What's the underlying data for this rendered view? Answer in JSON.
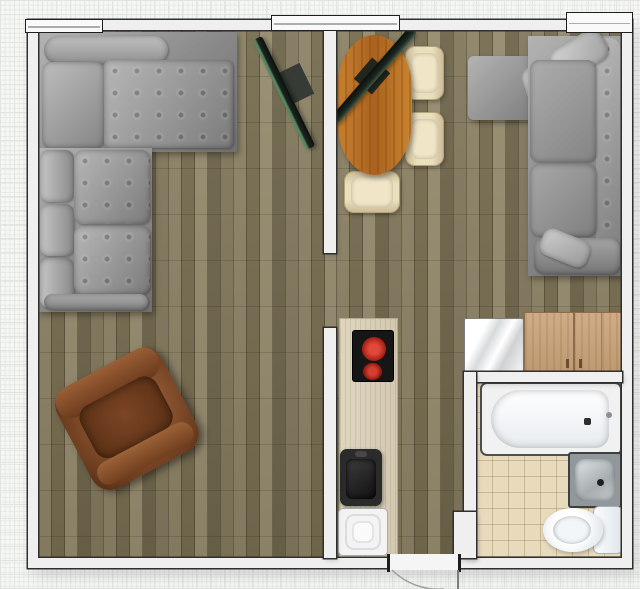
{
  "scene": {
    "kind": "floor-plan",
    "view": "top-down 2D",
    "background": "graph-paper grid",
    "text_visible": "none"
  },
  "palette": {
    "paper": "#f6f7f4",
    "grid_line": "#e0e5e0",
    "wall_fill": "#efefef",
    "wall_line": "#2f2f2f",
    "floor_wood": "#7f755a",
    "counter_wood": "#dbd1ba",
    "bath_tile": "#e8dabd",
    "sofa_gray": "#9a9a9a",
    "armchair_brown": "#7c4a28",
    "table_wood": "#c07a30",
    "chair_beige": "#e6d8b6",
    "tv_dark": "#15211b",
    "tv_green_edge": "#57865f",
    "burner_red": "#c43327",
    "steel": "#aab0b2",
    "fixture_white": "#f7f9fa",
    "wardrobe_tan": "#c8a47e"
  },
  "rooms": [
    {
      "id": "living-room",
      "position": "left",
      "floor": "wood planks"
    },
    {
      "id": "dining-living-area",
      "position": "top-right",
      "floor": "wood planks"
    },
    {
      "id": "kitchen-hall",
      "position": "bottom-center",
      "floor": "wood planks"
    },
    {
      "id": "bathroom",
      "position": "bottom-right",
      "floor": "beige tile"
    }
  ],
  "openings": {
    "windows": [
      "window-top-left",
      "window-top-center",
      "window-top-right-corner"
    ],
    "doors": [
      "entrance-door-bottom (swing arc outside)",
      "living-room-wall-opening"
    ]
  },
  "furniture": [
    {
      "id": "sectional-sofa-left",
      "desc": "gray L-shaped corner sofa",
      "room": "living-room"
    },
    {
      "id": "armchair",
      "desc": "brown leather armchair, rotated",
      "room": "living-room"
    },
    {
      "id": "tv-living-room",
      "desc": "flat TV on diagonal",
      "room": "living-room"
    },
    {
      "id": "dining-table",
      "desc": "oval orange-wood table",
      "room": "dining-living-area"
    },
    {
      "id": "dining-chair-1",
      "desc": "beige chair right of table",
      "room": "dining-living-area"
    },
    {
      "id": "dining-chair-2",
      "desc": "beige chair right of table",
      "room": "dining-living-area"
    },
    {
      "id": "dining-chair-3",
      "desc": "beige chair below table",
      "room": "dining-living-area"
    },
    {
      "id": "tv-dining",
      "desc": "flat TV on diagonal over table corner",
      "room": "dining-living-area"
    },
    {
      "id": "sectional-sofa-right",
      "desc": "gray L-shaped corner sofa",
      "room": "dining-living-area"
    },
    {
      "id": "fridge",
      "desc": "white glossy fridge top",
      "room": "dining-living-area"
    },
    {
      "id": "wardrobe",
      "desc": "tan two-door cabinet",
      "room": "dining-living-area"
    },
    {
      "id": "kitchen-counter",
      "desc": "light wood counter strip",
      "room": "kitchen-hall"
    },
    {
      "id": "cooktop",
      "desc": "black hob with two red burners",
      "room": "kitchen-hall"
    },
    {
      "id": "kitchen-sink",
      "desc": "black single-bowl sink",
      "room": "kitchen-hall"
    },
    {
      "id": "washing-machine",
      "desc": "white appliance, concentric top",
      "room": "kitchen-hall"
    },
    {
      "id": "bathtub",
      "desc": "white tub along bathroom top wall",
      "room": "bathroom"
    },
    {
      "id": "bathroom-sink",
      "desc": "square stainless basin",
      "room": "bathroom"
    },
    {
      "id": "toilet",
      "desc": "white toilet, tank at right",
      "room": "bathroom"
    }
  ]
}
